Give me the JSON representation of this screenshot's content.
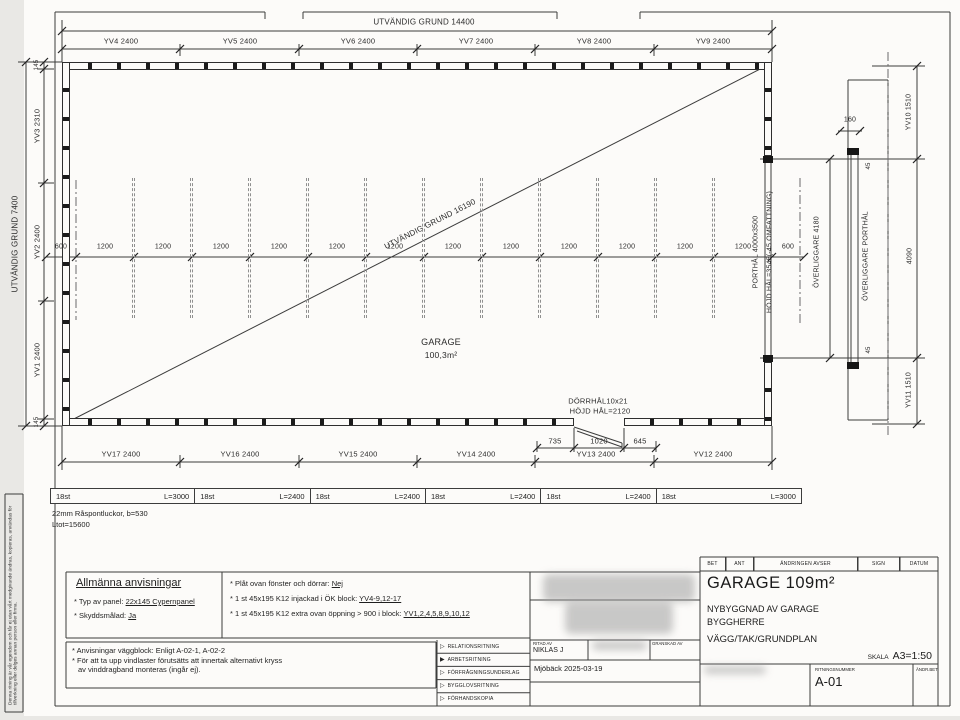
{
  "colors": {
    "ink": "#3c3c3c",
    "paper": "#fcfbf9",
    "margin": "#e9e8e5"
  },
  "page": {
    "copyright": "Denna ritning är vår egendom och får ej utan vårt medgivande ändras, kopieras, användas för tillverkning eller delges annan person eller firma."
  },
  "plan": {
    "top_total": "UTVÄNDIG GRUND 14400",
    "top_chain": [
      "YV4 2400",
      "YV5 2400",
      "YV6 2400",
      "YV7 2400",
      "YV8 2400",
      "YV9 2400"
    ],
    "left_total": "UTVÄNDIG GRUND 7400",
    "left_chain": [
      "145",
      "YV3 2310",
      "YV2 2400",
      "YV1 2400",
      "145"
    ],
    "stud_chain": [
      "600",
      "1200",
      "1200",
      "1200",
      "1200",
      "1200",
      "1200",
      "1200",
      "1200",
      "1200",
      "1200",
      "1200",
      "1200",
      "600"
    ],
    "diagonal": "UTVÄNDIG GRUND 16190",
    "room_name": "GARAGE",
    "room_area": "100,3m²",
    "door_label1": "DÖRRHÅL10x21",
    "door_label2": "HÖJD HÅL=2120",
    "door_dims": [
      "735",
      "1020",
      "645"
    ],
    "bottom_chain": [
      "YV17 2400",
      "YV16 2400",
      "YV15 2400",
      "YV14 2400",
      "YV13 2400",
      "YV12 2400"
    ],
    "port_label": "PORTHÅL 4000x3500",
    "port_height": "HÖJD HÅL=3545(-45 OMFATTNING)",
    "overliggare_dim": "ÖVERLIGGARE 4180",
    "detail": {
      "width": "160",
      "label": "ÖVERLIGGARE PORTHÅL",
      "t45": "45",
      "length": "4090",
      "b45": "45",
      "yv10": "YV10 1510",
      "yv11": "YV11 1510"
    }
  },
  "timber_table": {
    "cells": [
      {
        "qty": "18st",
        "len": "L=3000"
      },
      {
        "qty": "18st",
        "len": "L=2400"
      },
      {
        "qty": "18st",
        "len": "L=2400"
      },
      {
        "qty": "18st",
        "len": "L=2400"
      },
      {
        "qty": "18st",
        "len": "L=2400"
      },
      {
        "qty": "18st",
        "len": "L=3000"
      }
    ],
    "material": "22mm Råspontluckor, b=530",
    "total": "Ltot=15600"
  },
  "notes": {
    "heading": "Allmänna anvisningar",
    "panel_label": "* Typ av panel: ",
    "panel_value": "22x145 Cypernpanel",
    "paint_label": "* Skyddsmålad: ",
    "paint_value": "Ja",
    "plat_label": "* Plåt ovan fönster och dörrar: ",
    "plat_value": "Nej",
    "k12_label": "* 1 st 45x195 K12 injackad i ÖK block: ",
    "k12_value": "YV4-9,12-17",
    "k12b_label": "* 1 st 45x195 K12 extra ovan öppning > 900 i block: ",
    "k12b_value": "YV1,2,4,5,8,9,10,12",
    "wall_note": "* Anvisningar väggblock: Enligt A-02-1, A-02-2",
    "wind_note1": "* För att ta upp vindlaster förutsätts att innertak alternativt kryss",
    "wind_note2": "av vinddragband monteras (ingår ej)."
  },
  "titleblock": {
    "rev_headers": [
      "BET",
      "ANT",
      "ÄNDRINGEN AVSER",
      "SIGN",
      "DATUM"
    ],
    "doc_types": [
      "RELATIONSRITNING",
      "ARBETSRITNING",
      "FÖRFRÅGNINGSUNDERLAG",
      "BYGGLOVSRITNING",
      "FÖRHANDSKOPIA"
    ],
    "selected_doc_type": "ARBETSRITNING",
    "ritad_av_label": "RITAD AV",
    "ritad_av": "NIKLAS J",
    "granskad_av_label": "GRANSKAD AV",
    "place_date": "Mjöbäck 2025-03-19",
    "title": "GARAGE 109m²",
    "sub1": "NYBYGGNAD AV GARAGE",
    "sub2": "BYGGHERRE",
    "sub3": "VÄGG/TAK/GRUNDPLAN",
    "scale_label": "SKALA",
    "scale": "A3=1:50",
    "drawing_no_label": "RITNINGSNUMMER",
    "drawing_no": "A-01",
    "bet_label": "ÄNDR.BET"
  }
}
